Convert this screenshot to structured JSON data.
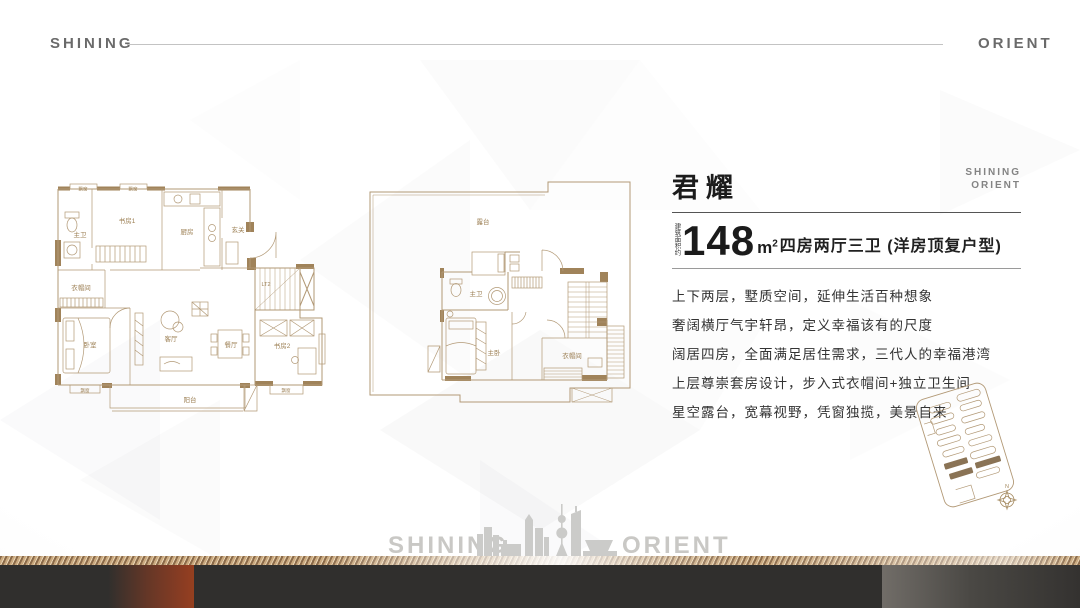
{
  "header": {
    "brand_left": "SHINING",
    "brand_right": "ORIENT"
  },
  "info": {
    "title": "君耀",
    "brand_small_line1": "SHINING",
    "brand_small_line2": "ORIENT",
    "area_prefix": "建筑面积约",
    "area_value": "148",
    "area_unit": "m",
    "area_sup": "2",
    "area_desc": "四房两厅三卫 (洋房顶复户型)",
    "features": [
      "上下两层，墅质空间，延伸生活百种想象",
      "奢阔横厅气宇轩昂，定义幸福该有的尺度",
      "阔居四房，全面满足居住需求，三代人的幸福港湾",
      "上层尊崇套房设计，步入式衣帽间+独立卫生间",
      "星空露台，宽幕视野，凭窗独揽，美景自来"
    ]
  },
  "plans": {
    "lower": {
      "labels": {
        "bay": "飘窗",
        "master_bath": "主卫",
        "study1": "书房1",
        "kitchen": "厨房",
        "foyer": "玄关",
        "cloak": "衣帽间",
        "bedroom": "卧室",
        "living": "客厅",
        "dining": "餐厅",
        "study2": "书房2",
        "balcony": "阳台",
        "elevator": "LT2"
      }
    },
    "upper": {
      "labels": {
        "terrace": "露台",
        "master_bath": "主卫",
        "master_bedroom": "主卧",
        "cloak": "衣帽间"
      }
    }
  },
  "keyplan": {
    "north": "N"
  },
  "footer": {
    "brand_left": "SHINING",
    "brand_right": "ORIENT"
  },
  "colors": {
    "accent_line": "#b29976",
    "wall_fill": "#a0835a",
    "bar_dark": "#302f2d",
    "bar_red": "#8f3d22",
    "gold": "#c9a87e"
  }
}
